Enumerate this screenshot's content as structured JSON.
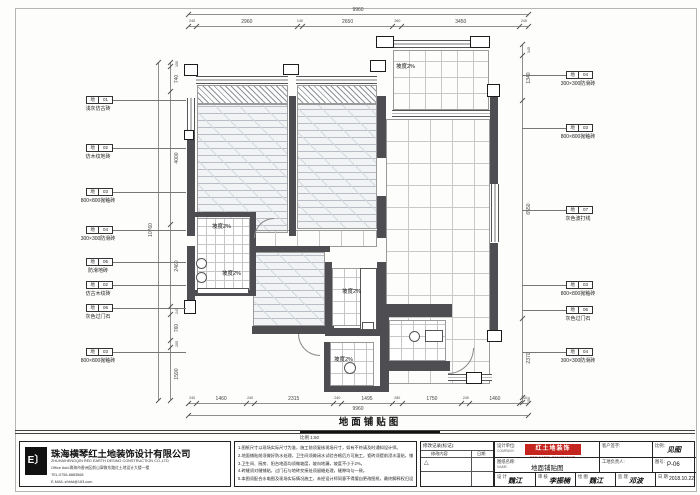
{
  "drawing": {
    "title": "地面铺贴图",
    "scale_text": "比例 1:50",
    "slope_text": "坡度2%"
  },
  "dims": {
    "top": {
      "total": "9960",
      "segments": [
        240,
        2960,
        140,
        2650,
        260,
        3450,
        240
      ]
    },
    "bottom": {
      "total": "9960",
      "segments": [
        240,
        1460,
        240,
        2315,
        240,
        1495,
        280,
        1750,
        240,
        1460,
        240
      ]
    },
    "left": {
      "total": "10760",
      "segments": [
        150,
        740,
        4000,
        2460,
        245,
        760,
        205,
        1590
      ]
    },
    "right": {
      "segments": [
        345,
        1340,
        6550,
        2370,
        150
      ]
    }
  },
  "callouts": {
    "left": [
      {
        "code": "地",
        "num": "01",
        "label": "浅灰仿古砖"
      },
      {
        "code": "地",
        "num": "02",
        "label": "仿木纹地砖"
      },
      {
        "code": "地",
        "num": "03",
        "label": "800×800抛釉砖"
      },
      {
        "code": "地",
        "num": "04",
        "label": "300×300防滑砖"
      },
      {
        "code": "地",
        "num": "05",
        "label": "防滑地砖"
      },
      {
        "code": "地",
        "num": "02",
        "label": "仿古木纹砖"
      },
      {
        "code": "地",
        "num": "06",
        "label": "灰色过门石"
      },
      {
        "code": "地",
        "num": "03",
        "label": "800×800抛釉砖"
      }
    ],
    "right": [
      {
        "code": "地",
        "num": "04",
        "label": "300×300防滑砖"
      },
      {
        "code": "地",
        "num": "03",
        "label": "800×800抛釉砖"
      },
      {
        "code": "地",
        "num": "07",
        "label": "灰色波打线"
      },
      {
        "code": "地",
        "num": "03",
        "label": "800×800抛釉砖"
      },
      {
        "code": "地",
        "num": "06",
        "label": "灰色过门石"
      },
      {
        "code": "地",
        "num": "04",
        "label": "300×300防滑砖"
      }
    ]
  },
  "notes": {
    "items": [
      "1.图纸尺寸以现场实际尺寸为准，施工前须复核现场尺寸，如有不符请及时通知设计师。",
      "2.地面铺贴前须做好防水处理，卫生间须做闭水试验合格后方可施工，瓷砖须提前浸水湿贴，铺贴须平整牢固。",
      "3.卫生间、厨房、阳台地面均须做坡度，坡向地漏，坡度不小于2%。",
      "4.砖缝须对缝铺贴，过门石与地砖交接处须留缝处理，缝隙均匀一致。",
      "5.本图须配合水电图及现场实际情况施工，未经设计师同意不得擅自更改图纸，最终解释权归设计方所有。"
    ]
  },
  "company": {
    "logo_mark": "E〕",
    "name": "珠海横琴红土地装饰设计有限公司",
    "name_en": "ZHUHAIHENGQIN RED EARTH DESING CONSTRUCTION CO.,LTD",
    "address": "Office Add:珠海市香洲区前山翠微东路红土地设计大楼一楼",
    "tel": "TEL:0756-8883568",
    "email": "E-MAIL:zhhtd@163.com"
  },
  "titleblock": {
    "revision_header": "修改记录(标记):",
    "revision_col1": "修改内容",
    "revision_col2": "日期",
    "revision_mark": "△",
    "design_unit_label": "设计单位:",
    "design_unit_sub": "COMPANY:",
    "logo_text": "红土地装饰",
    "logo_sub": "RED EARTH DECORATION",
    "logo_color": "#c5261f",
    "drawing_name_label": "图纸名称:",
    "drawing_name_sub": "NAME:",
    "drawing_name_value": "地面铺贴图",
    "client_sign_label": "客户签字:",
    "site_manager_label": "工地负责人:",
    "scale_label": "比例:",
    "scale_value": "见图",
    "number_label": "图号:",
    "number_value": "P-06",
    "signs": [
      {
        "label": "设 计",
        "value": "魏江"
      },
      {
        "label": "审 核",
        "value": "李振楠"
      },
      {
        "label": "绘 图",
        "value": "魏江"
      },
      {
        "label": "监 理",
        "value": "邓波"
      },
      {
        "label": "日 期",
        "value": "2018.10.22"
      }
    ]
  }
}
